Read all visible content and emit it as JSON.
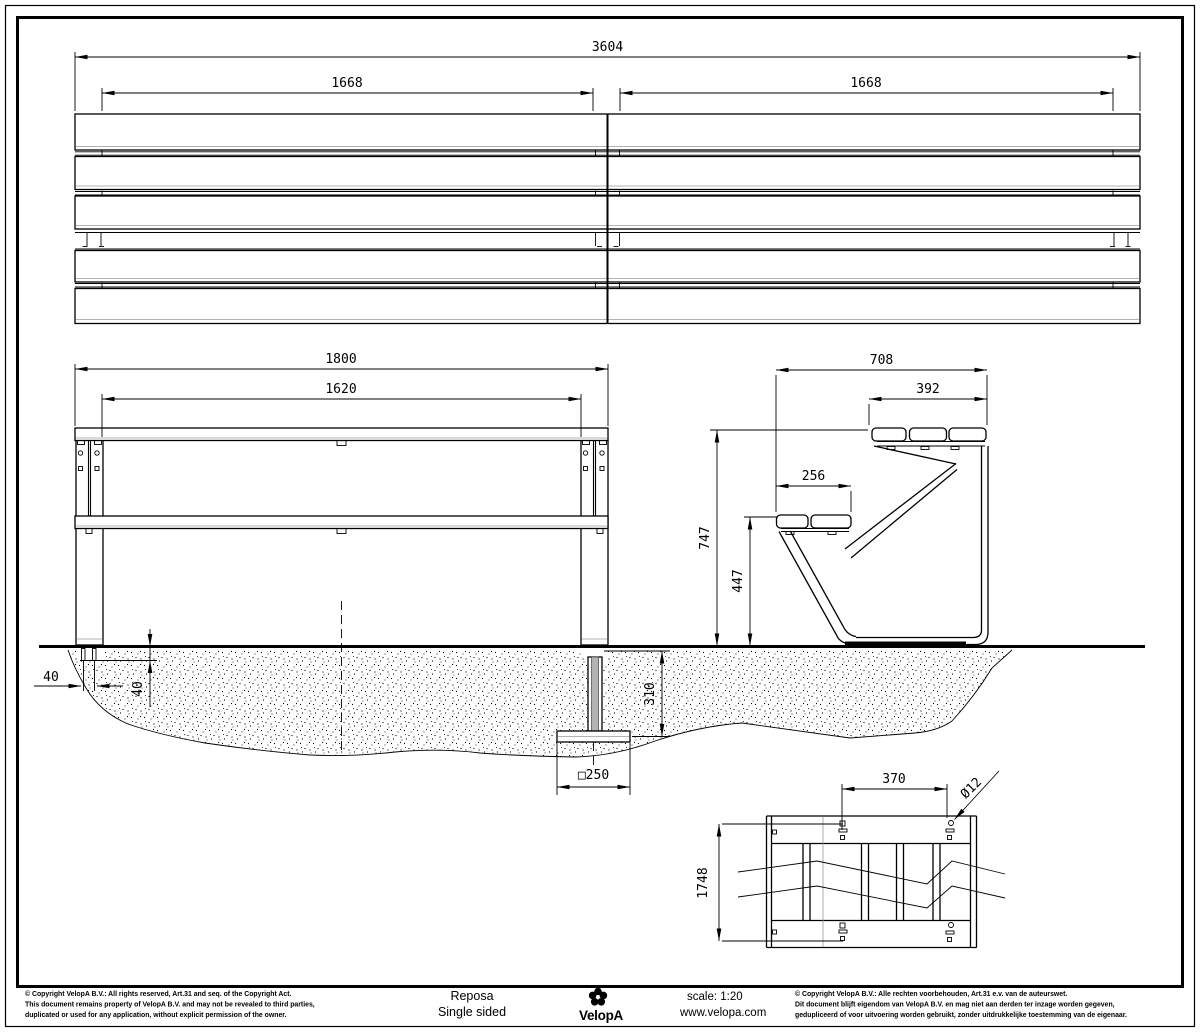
{
  "sheet": {
    "line_color": "#000000",
    "background": "#ffffff",
    "anchor_rod_color": "#b3b3b3"
  },
  "dims": {
    "overall_length": "3604",
    "section_left": "1668",
    "section_right": "1668",
    "front_overall": "1800",
    "front_inner": "1620",
    "side_overall": "708",
    "table_depth": "392",
    "seat_depth": "256",
    "table_height": "747",
    "seat_height": "447",
    "anchor_spacing": "40",
    "anchor_depth": "40",
    "foundation_depth": "310",
    "foundation_plate": "□250",
    "bolt_spacing": "370",
    "bolt_hole": "Ø12",
    "frame_length": "1748"
  },
  "footer": {
    "left_copyright": [
      "© Copyright VelopA B.V.: All rights reserved, Art.31 and seq. of the Copyright Act.",
      "This document remains property of VelopA B.V. and may not be revealed to third parties,",
      "duplicated or used for any application, without explicit permission of the owner."
    ],
    "product_name": "Reposa",
    "product_variant": "Single sided",
    "brand": "VelopA",
    "scale_label": "scale: 1:20",
    "website": "www.velopa.com",
    "right_copyright": [
      "© Copyright VelopA B.V.: Alle rechten voorbehouden, Art.31 e.v. van de auteurswet.",
      "Dit document blijft eigendom van VelopA B.V. en mag niet aan derden ter inzage worden gegeven,",
      "gedupliceerd of voor uitvoering worden gebruikt, zonder uitdrukkelijke toestemming van de eigenaar."
    ]
  }
}
